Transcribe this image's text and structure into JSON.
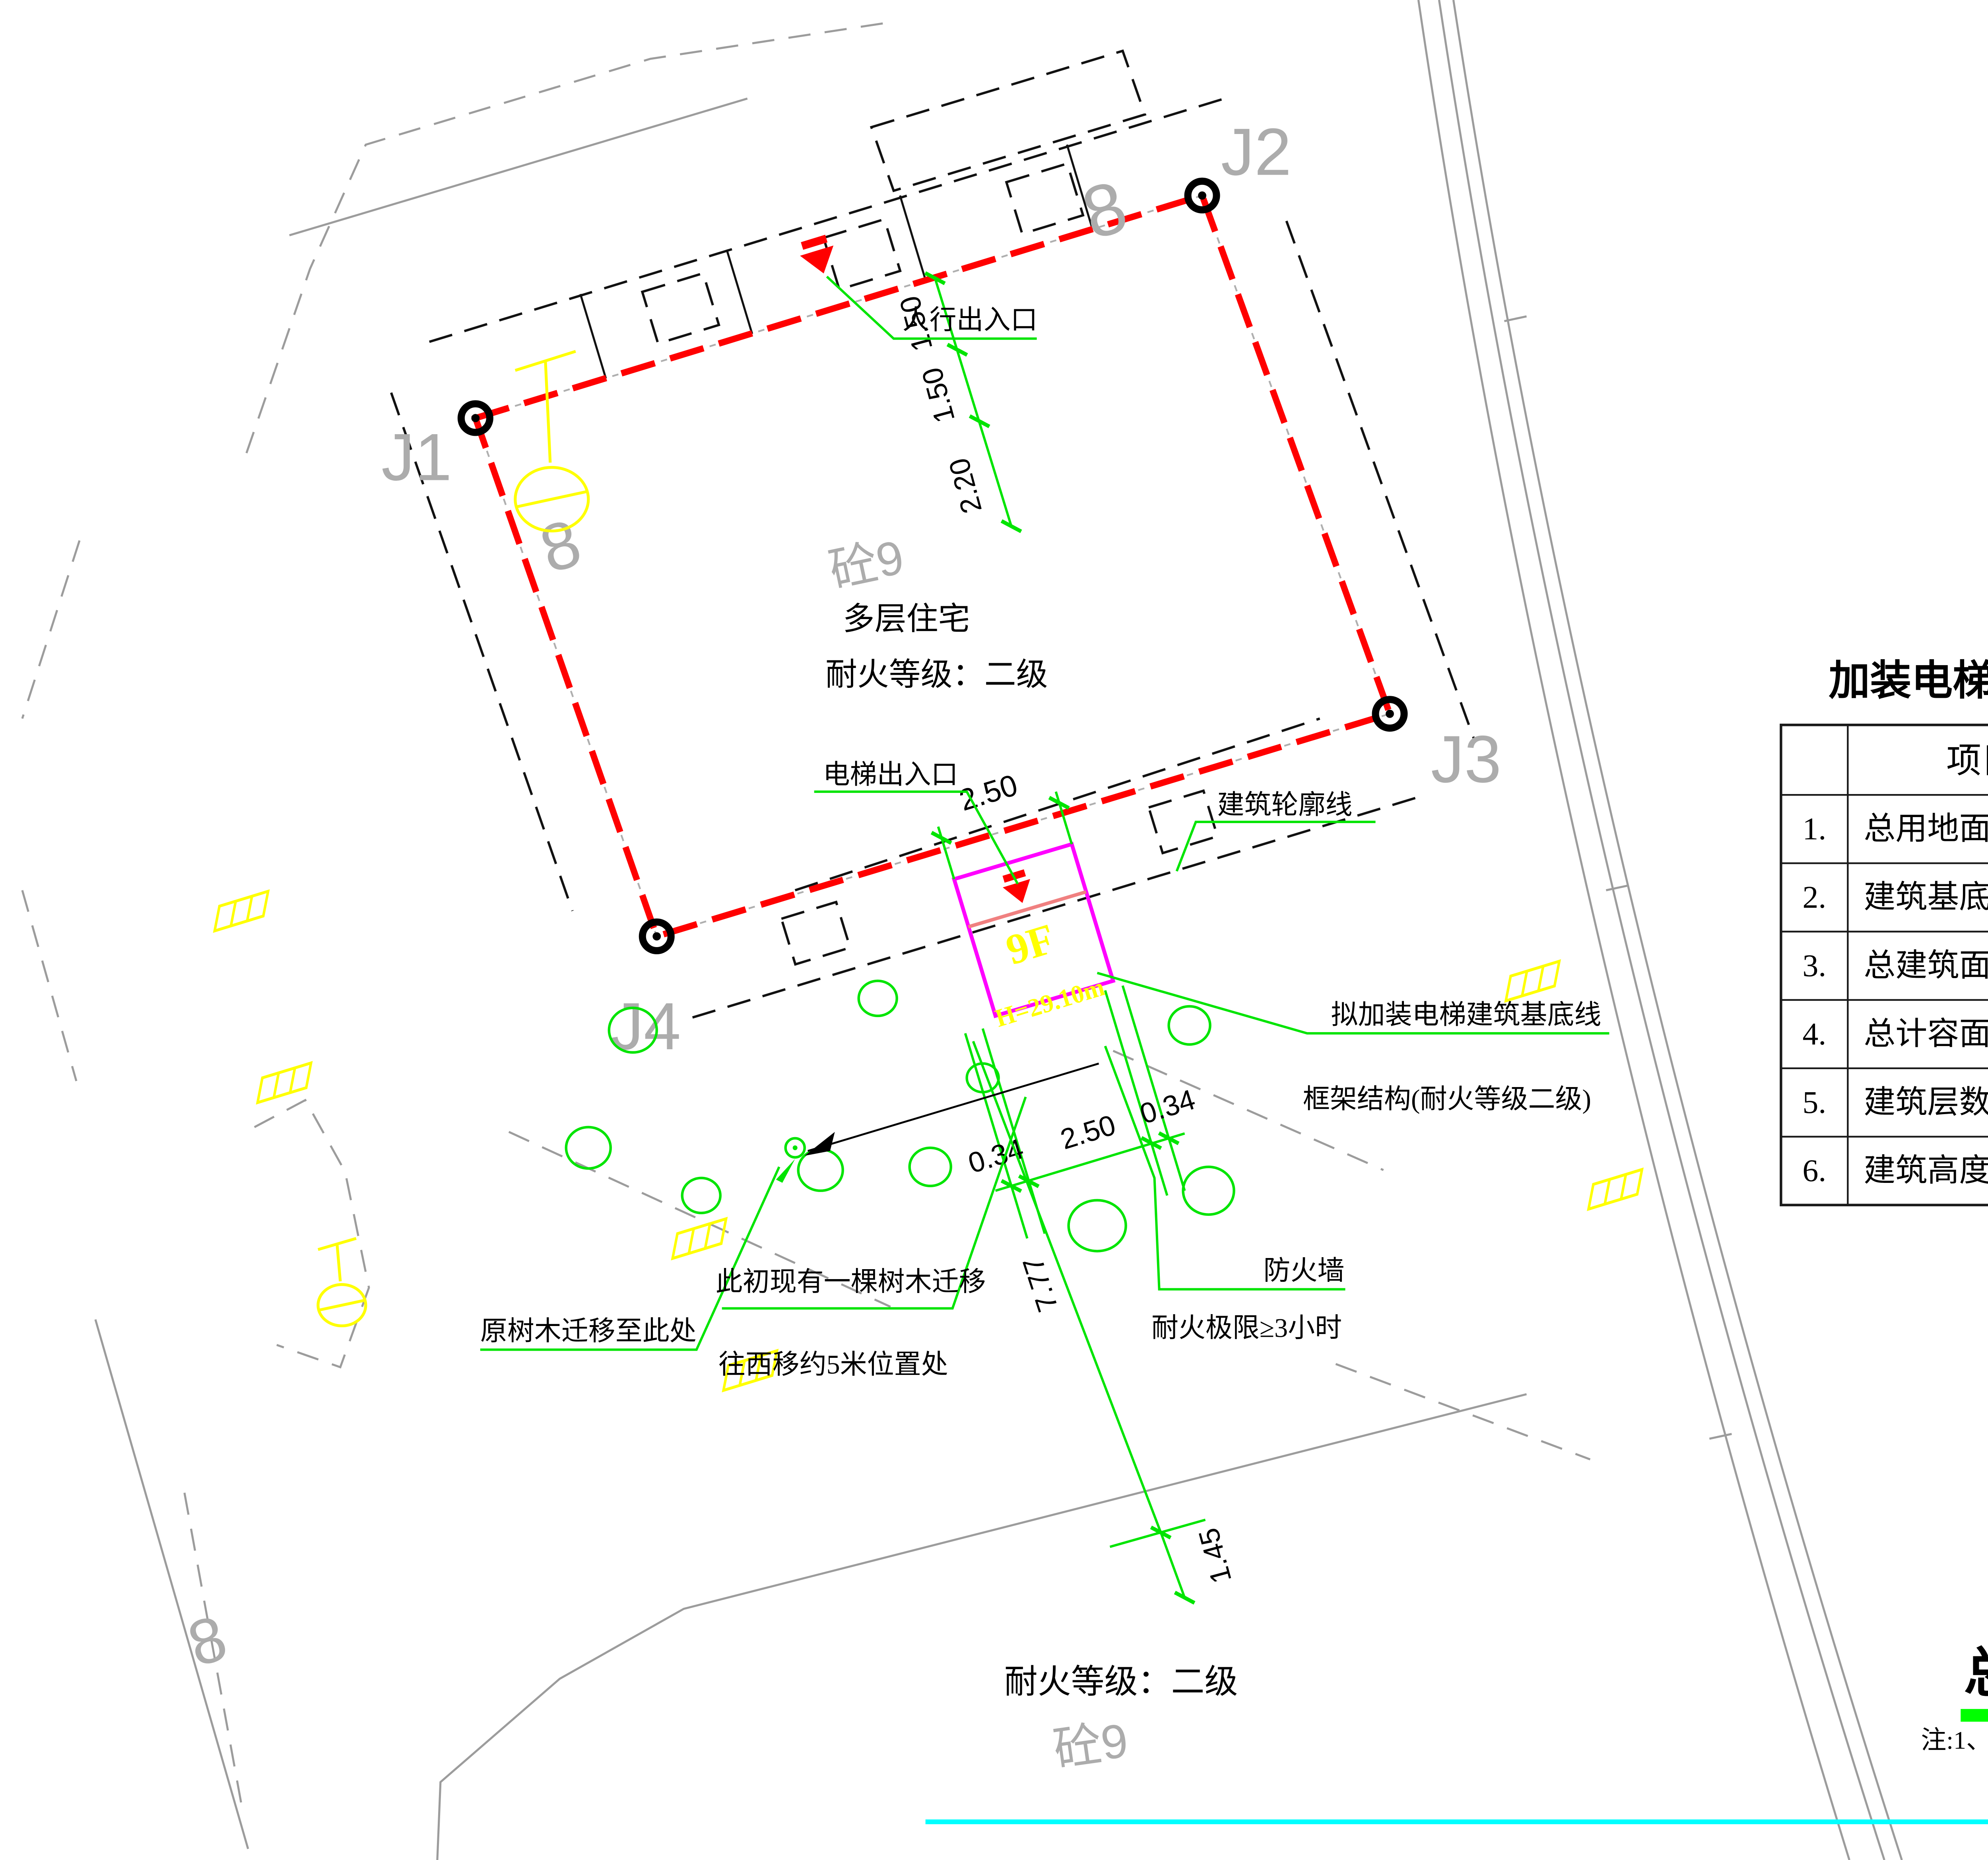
{
  "site_plan": {
    "corner_labels": {
      "j1": "J1",
      "j2": "J2",
      "j3": "J3",
      "j4": "J4"
    },
    "building": {
      "name_line1": "多层住宅",
      "name_line2": "耐火等级：二级",
      "mark_top": "砼9",
      "mark_bottom": "砼9",
      "unit_mark": "8"
    },
    "elevator": {
      "floors": "9F",
      "height": "H=29.10m"
    },
    "annotations": {
      "pedestrian_entrance": "人行出入口",
      "elevator_entrance": "电梯出入口",
      "building_outline": "建筑轮廓线",
      "proposed_base_line": "拟加装电梯建筑基底线",
      "frame_structure": "框架结构(耐火等级二级)",
      "firewall": "防火墙",
      "fire_resistance_limit": "耐火极限≥3小时",
      "tree_moved_here": "原树木迁移至此处",
      "tree_note_line1": "此初现有一棵树木迁移",
      "tree_note_line2": "往西移约5米位置处",
      "fire_rating_note": "耐火等级：二级"
    },
    "dimensions": {
      "top_width": "2.50",
      "offset_a": "1.50",
      "offset_b": "1.50",
      "offset_c": "2.20",
      "south_left": "0.34",
      "south_width": "2.50",
      "south_right": "0.34",
      "south_length": "7.77",
      "boundary_gap": "1.45"
    }
  },
  "indicator_table": {
    "title": "加装电梯主要技术经济指标表",
    "headers": [
      "",
      "项目",
      "单位",
      "数值"
    ],
    "rows": [
      [
        "1.",
        "总用地面积",
        "m²",
        "5.50"
      ],
      [
        "2.",
        "建筑基底面积",
        "m²",
        "5.50"
      ],
      [
        "3.",
        "总建筑面积",
        "m²",
        "79.50"
      ],
      [
        "4.",
        "总计容面积",
        "m²",
        "79.50"
      ],
      [
        "5.",
        "建筑层数",
        "层",
        "9"
      ],
      [
        "6.",
        "建筑高度",
        "m",
        "29.10"
      ]
    ]
  },
  "title_block": {
    "drawing_title": "总平面图",
    "drawing_scale": "1:200",
    "note": "注:1、本图尺寸以米为单位。"
  },
  "colors": {
    "boundary_red": "#FF0000",
    "elevator_magenta": "#FF00FF",
    "annotation_green": "#00E400",
    "symbol_yellow": "#FFFF00",
    "divider_cyan": "#00FFFF",
    "background_gray": "#9C9C9C",
    "entrance_divider_salmon": "#F08080"
  }
}
